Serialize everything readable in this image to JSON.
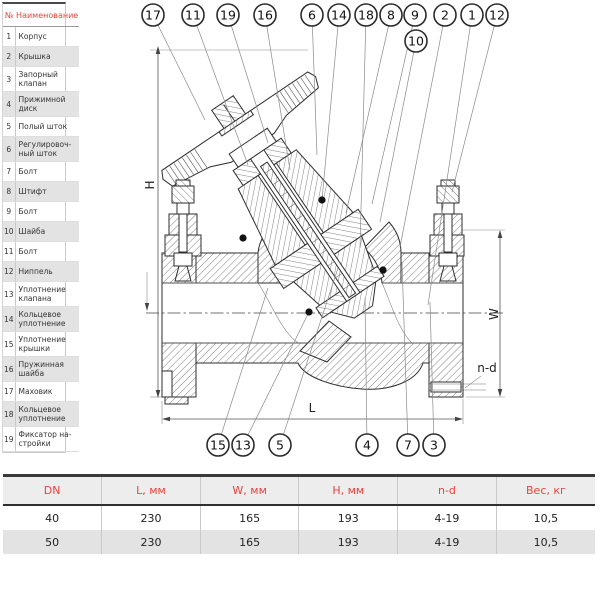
{
  "parts_table": {
    "header": {
      "num": "№",
      "name": "Наименование"
    },
    "rows": [
      {
        "num": "1",
        "name": "Корпус",
        "lines": 1
      },
      {
        "num": "2",
        "name": "Крышка",
        "lines": 1
      },
      {
        "num": "3",
        "name": "Запорный\nклапан",
        "lines": 2
      },
      {
        "num": "4",
        "name": "Прижимной\nдиск",
        "lines": 2
      },
      {
        "num": "5",
        "name": "Полый шток",
        "lines": 1
      },
      {
        "num": "6",
        "name": "Регулировоч-\nный шток",
        "lines": 2
      },
      {
        "num": "7",
        "name": "Болт",
        "lines": 1
      },
      {
        "num": "8",
        "name": "Штифт",
        "lines": 1
      },
      {
        "num": "9",
        "name": "Болт",
        "lines": 1
      },
      {
        "num": "10",
        "name": "Шайба",
        "lines": 1
      },
      {
        "num": "11",
        "name": "Болт",
        "lines": 1
      },
      {
        "num": "12",
        "name": "Ниппель",
        "lines": 1
      },
      {
        "num": "13",
        "name": "Уплотнение\nклапана",
        "lines": 2
      },
      {
        "num": "14",
        "name": "Кольцевое\nуплотнение",
        "lines": 2
      },
      {
        "num": "15",
        "name": "Уплотнение\nкрышки",
        "lines": 2
      },
      {
        "num": "16",
        "name": "Пружинная\nшайба",
        "lines": 2
      },
      {
        "num": "17",
        "name": "Маховик",
        "lines": 1
      },
      {
        "num": "18",
        "name": "Кольцевое\nуплотнение",
        "lines": 2
      },
      {
        "num": "19",
        "name": "Фиксатор на-\nстройки",
        "lines": 2
      }
    ]
  },
  "drawing": {
    "dim_labels": {
      "h": "H",
      "w": "W",
      "l": "L",
      "nd": "n-d"
    },
    "callouts": [
      {
        "n": "17",
        "cx": 153,
        "cy": 15,
        "tx": 205,
        "ty": 120
      },
      {
        "n": "11",
        "cx": 193,
        "cy": 15,
        "tx": 248,
        "ty": 165
      },
      {
        "n": "19",
        "cx": 228,
        "cy": 15,
        "tx": 268,
        "ty": 143
      },
      {
        "n": "16",
        "cx": 265,
        "cy": 15,
        "tx": 290,
        "ty": 170
      },
      {
        "n": "6",
        "cx": 312,
        "cy": 15,
        "tx": 317,
        "ty": 155
      },
      {
        "n": "14",
        "cx": 339,
        "cy": 15,
        "tx": 322,
        "ty": 200
      },
      {
        "n": "18",
        "cx": 366,
        "cy": 15,
        "tx": 360,
        "ty": 248
      },
      {
        "n": "8",
        "cx": 391,
        "cy": 15,
        "tx": 346,
        "ty": 213
      },
      {
        "n": "9",
        "cx": 415,
        "cy": 15,
        "tx": 372,
        "ty": 204
      },
      {
        "n": "10",
        "cx": 416,
        "cy": 41,
        "tx": 380,
        "ty": 222
      },
      {
        "n": "2",
        "cx": 445,
        "cy": 15,
        "tx": 400,
        "ty": 247
      },
      {
        "n": "1",
        "cx": 472,
        "cy": 15,
        "tx": 428,
        "ty": 305
      },
      {
        "n": "12",
        "cx": 497,
        "cy": 15,
        "tx": 452,
        "ty": 192
      },
      {
        "n": "15",
        "cx": 218,
        "cy": 445,
        "tx": 268,
        "ty": 288
      },
      {
        "n": "13",
        "cx": 243,
        "cy": 445,
        "tx": 308,
        "ty": 314
      },
      {
        "n": "5",
        "cx": 280,
        "cy": 445,
        "tx": 338,
        "ty": 268
      },
      {
        "n": "4",
        "cx": 367,
        "cy": 445,
        "tx": 365,
        "ty": 298
      },
      {
        "n": "7",
        "cx": 408,
        "cy": 445,
        "tx": 402,
        "ty": 262
      },
      {
        "n": "3",
        "cx": 434,
        "cy": 445,
        "tx": 430,
        "ty": 302
      }
    ],
    "seal_dots": [
      [
        243,
        238
      ],
      [
        309,
        312
      ],
      [
        383,
        270
      ],
      [
        322,
        200
      ]
    ]
  },
  "dims_table": {
    "headers": [
      "DN",
      "L, мм",
      "W, мм",
      "H, мм",
      "n-d",
      "Вес, кг"
    ],
    "rows": [
      [
        "40",
        "230",
        "165",
        "193",
        "4-19",
        "10,5"
      ],
      [
        "50",
        "230",
        "165",
        "193",
        "4-19",
        "10,5"
      ]
    ]
  },
  "colors": {
    "accent": "#e8433e",
    "row_alt": "#e3e3e3",
    "line": "#2e2e2e"
  }
}
